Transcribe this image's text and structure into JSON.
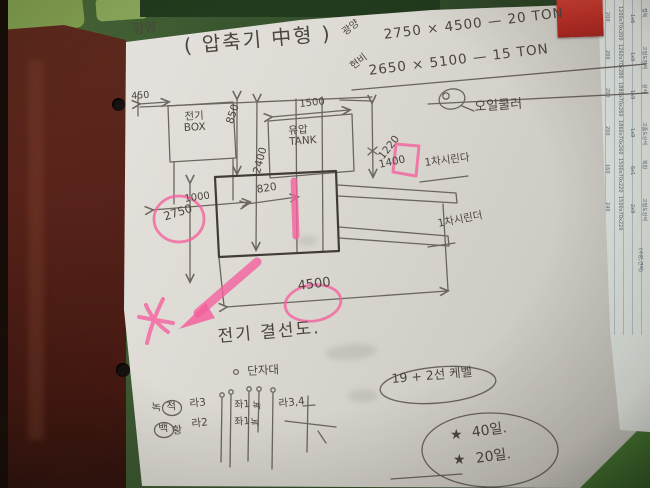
{
  "title": {
    "project": "광양",
    "main": "( 압축기 中형 )"
  },
  "specs": {
    "row1_label": "광양",
    "row1_value": "2750 × 4500 — 20 TON",
    "row2_label": "현비",
    "row2_value": "2650 × 5100 — 15 TON"
  },
  "machine": {
    "oil_cooler_label": "오일쿨러",
    "electric_box": "전기\nBOX",
    "tank": "유압\nTANK",
    "cylinder1_label": "1차시린다",
    "cylinder2_label": "1차시린더",
    "dims": {
      "left_offset": "450",
      "box_width": "1000",
      "height_850": "850",
      "tank_width": "1500",
      "height_2400": "2400",
      "right_upper": "1220",
      "right_lower": "1400",
      "inner_width": "820",
      "depth": "2750",
      "total_width": "4500"
    }
  },
  "wiring": {
    "title": "전기 결선도.",
    "terminal_label": "단자대",
    "legend": {
      "green": "녹",
      "red": "적",
      "white": "백",
      "yellow": "황"
    },
    "columns": {
      "c1_top": "라3",
      "c1_bottom": "라2",
      "c2_top": "좌1",
      "c2_bottom": "좌1",
      "c3_top": "녹",
      "c3_bottom": "녹",
      "c4": "라3,4"
    },
    "cable_note": "19 + 2선 케벨"
  },
  "schedule": {
    "star": "★",
    "line1": "40일.",
    "line2": "20일."
  },
  "side_sheet": {
    "rows": [
      {
        "w": "200",
        "size": "1200x70x200",
        "qty": "1x6",
        "name": "접복"
      },
      {
        "w": "200",
        "size": "1260x70x280",
        "qty": "1x9",
        "name": "고밀도장석"
      },
      {
        "w": "200",
        "size": "1880x70x260",
        "qty": "1x9",
        "name": "삼석"
      },
      {
        "w": "200",
        "size": "1860x70x260",
        "qty": "1x9",
        "name": "고품도상석"
      },
      {
        "w": "160",
        "size": "1500x70x220",
        "qty": "6x1",
        "name": "복합"
      },
      {
        "w": "240",
        "size": "1500x70x220",
        "qty": "2x9",
        "name": "고밀도상석"
      }
    ],
    "footer": "(수량;견적)"
  },
  "colors": {
    "pink": "#f4629e",
    "pencil": "#57514a",
    "paper": "#dcd9d3",
    "table_green": "#3a5730",
    "wood": "#57231a",
    "sticker_red": "#c03028"
  }
}
